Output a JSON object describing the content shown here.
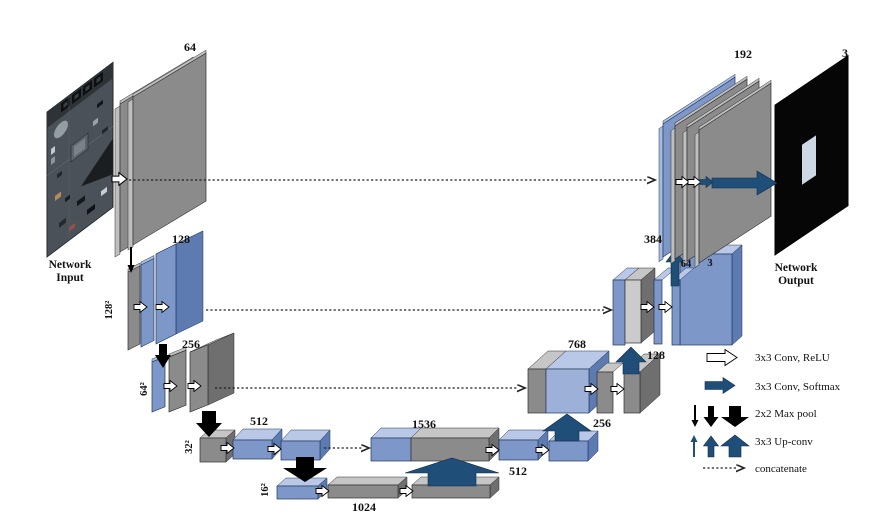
{
  "figure": {
    "type": "unet-architecture-diagram"
  },
  "palette": {
    "plate_gray": "#8b8b8b",
    "plate_gray_light": "#cbcbcb",
    "plate_blue": "#7d97c9",
    "plate_blue_light": "#b9c8e6",
    "arrow_dark_blue": "#1f4e79",
    "arrow_black": "#000000",
    "background": "#ffffff"
  },
  "input": {
    "title_line1": "Network",
    "title_line2": "Input"
  },
  "output": {
    "title_line1": "Network",
    "title_line2": "Output",
    "channels": "3"
  },
  "encoder": {
    "l1_channels": "64",
    "l2_channels": "128",
    "l2_size": "128²",
    "l3_channels": "256",
    "l3_size": "64²",
    "l4_channels": "512",
    "l4_size": "32²",
    "l5_channels": "1024",
    "l5_size": "16²"
  },
  "decoder": {
    "bottleneck_channels": "1536",
    "d4_channels": "512",
    "d4_out": "256",
    "d3_channels": "768",
    "d3_out": "128",
    "d2_channels": "384",
    "d2_mid": "64",
    "d2_out": "3",
    "d1_channels": "192"
  },
  "legend": {
    "conv_relu": "3x3 Conv, ReLU",
    "conv_softmax": "3x3 Conv, Softmax",
    "max_pool": "2x2 Max pool",
    "up_conv": "3x3 Up-conv",
    "concatenate": "concatenate"
  }
}
